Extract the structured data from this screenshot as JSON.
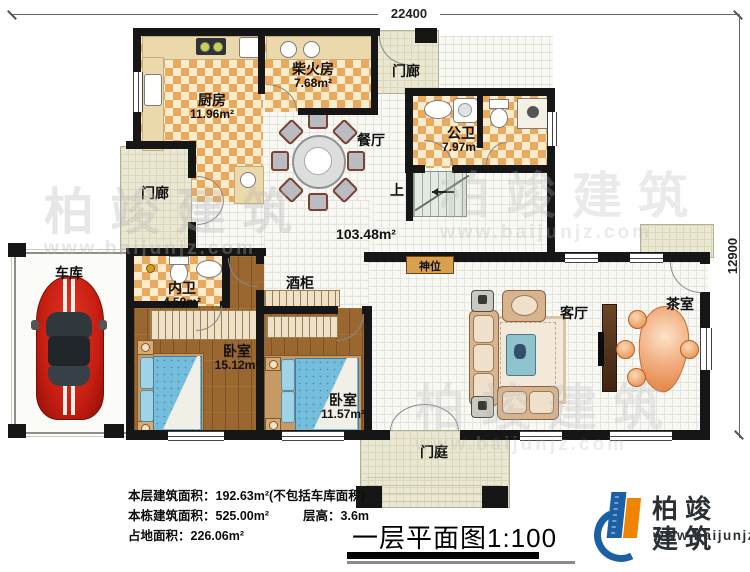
{
  "dimensions": {
    "top": "22400",
    "right": "12900"
  },
  "rooms": {
    "kitchen": {
      "label": "厨房",
      "area": "11.96m²"
    },
    "firewood": {
      "label": "柴火房",
      "area": "7.68m²"
    },
    "porch_top": {
      "label": "门廊"
    },
    "porch_left": {
      "label": "门廊"
    },
    "public_bath": {
      "label": "公卫",
      "area": "7.97m²"
    },
    "dining": {
      "label": "餐厅"
    },
    "stairs": {
      "label": "上"
    },
    "hall": {
      "area": "103.48m²"
    },
    "shrine": {
      "label": "神位"
    },
    "garage": {
      "label": "车库"
    },
    "inner_bath": {
      "label": "内卫",
      "area": "4.59m²"
    },
    "bedroom_1": {
      "label": "卧室",
      "area": "15.12m²"
    },
    "bedroom_2": {
      "label": "卧室",
      "area": "11.57m²"
    },
    "wine_cabinet": {
      "label": "酒柜"
    },
    "living": {
      "label": "客厅"
    },
    "tea": {
      "label": "茶室"
    },
    "entry_court": {
      "label": "门庭"
    }
  },
  "info": {
    "line1": {
      "label": "本层建筑面积：",
      "value": "192.63m²(不包括车库面积)"
    },
    "line2": {
      "label": "本栋建筑面积：",
      "value": "525.00m²",
      "label2": "层高：",
      "value2": "3.6m"
    },
    "line3": {
      "label": "占地面积：",
      "value": "226.06m²"
    }
  },
  "title": "一层平面图1:100",
  "brand": {
    "name": "柏竣建筑",
    "website": "www.baijunjz.com"
  },
  "watermark": {
    "text": "柏竣建筑",
    "website": "www.baijunjz.com"
  },
  "colors": {
    "tile": "#e9a95f",
    "wood": "#99672f",
    "wall": "#161616",
    "porch": "#eae7d2",
    "bed_blue": "#74bedb",
    "tea_orange": "#e8883f",
    "brand_blue": "#1b5fa5",
    "brand_orange": "#f08300"
  }
}
